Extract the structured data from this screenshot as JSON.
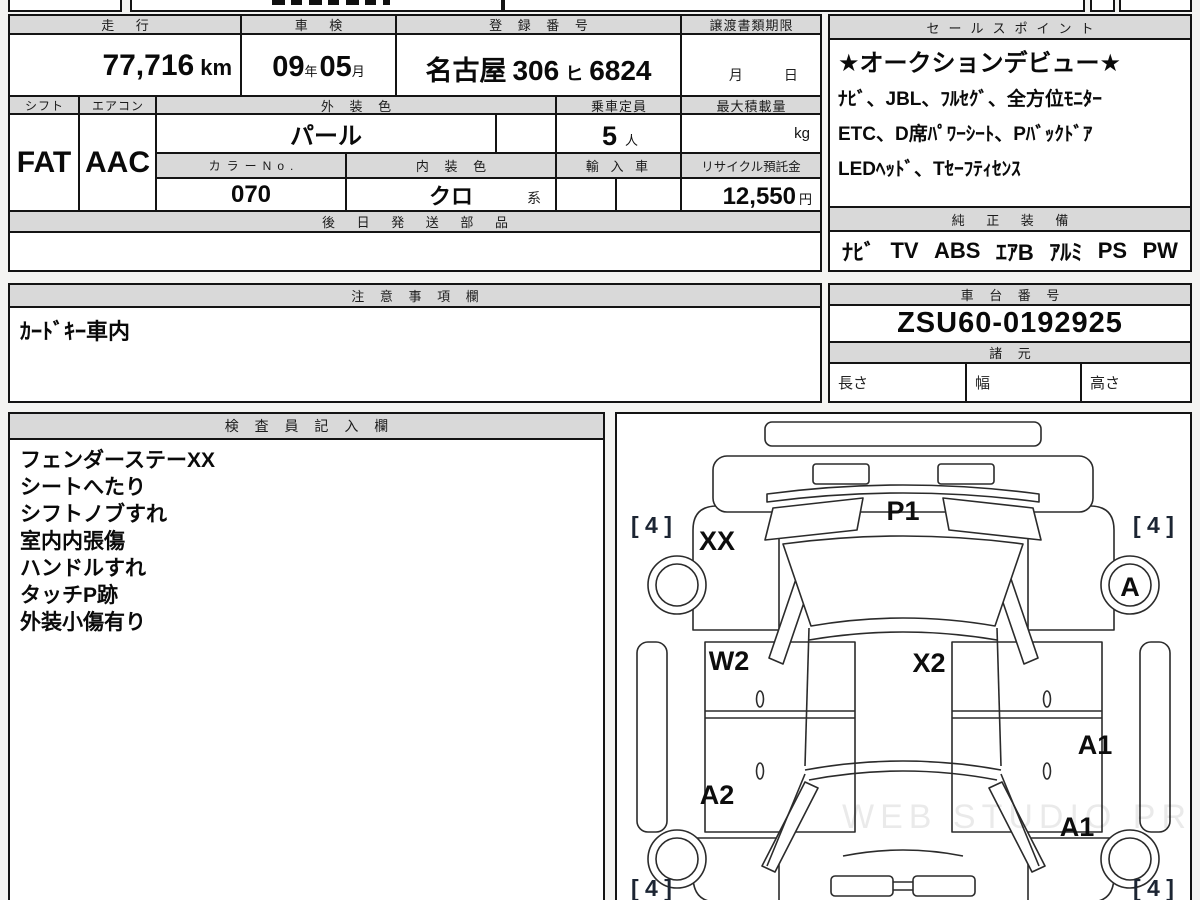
{
  "palette": {
    "header_fill": "#d9d9d9",
    "paper": "#ffffff",
    "line": "#141414"
  },
  "main": {
    "headers": {
      "mileage": "走 行",
      "inspection": "車 検",
      "registration": "登 録 番 号",
      "transfer_deadline": "譲渡書類期限",
      "shift": "シフト",
      "aircon": "エアコン",
      "exterior_color": "外 装 色",
      "capacity": "乗車定員",
      "max_load": "最大積載量",
      "color_no": "カラーNo.",
      "interior_color": "内 装 色",
      "import_car": "輸 入 車",
      "recycle_deposit": "リサイクル預託金",
      "later_parts": "後 日 発 送 部 品"
    },
    "values": {
      "mileage": "77,716",
      "mileage_unit": "km",
      "inspection_year": "09",
      "inspection_year_unit": "年",
      "inspection_month": "05",
      "inspection_month_unit": "月",
      "plate_city": "名古屋",
      "plate_class": "306",
      "plate_kana": "ヒ",
      "plate_number": "6824",
      "transfer_month": "月",
      "transfer_day": "日",
      "shift": "FAT",
      "aircon": "AAC",
      "exterior_color": "パール",
      "capacity": "5",
      "capacity_unit": "人",
      "max_load_unit": "kg",
      "color_no": "070",
      "interior_color": "クロ",
      "interior_suffix": "系",
      "recycle_amount": "12,550",
      "recycle_unit": "円"
    }
  },
  "sales": {
    "title": "セールスポイント",
    "lines": [
      "★オークションデビュー★",
      "ﾅﾋﾞ、JBL、ﾌﾙｾｸﾞ、全方位ﾓﾆﾀｰ",
      "ETC、D席ﾊﾟﾜｰｼｰﾄ、Pﾊﾞｯｸﾄﾞｱ",
      "LEDﾍｯﾄﾞ、Tｾｰﾌﾃｨｾﾝｽ"
    ]
  },
  "equipment": {
    "title": "純 正 装 備",
    "items": [
      "ﾅﾋﾞ",
      "TV",
      "ABS",
      "ｴｱB",
      "ｱﾙﾐ",
      "PS",
      "PW"
    ]
  },
  "notes": {
    "title": "注 意 事 項 欄",
    "line": "ｶｰﾄﾞｷｰ車内"
  },
  "chassis": {
    "title": "車 台 番 号",
    "value": "ZSU60-0192925"
  },
  "specs": {
    "title": "諸 元",
    "length_label": "長さ",
    "width_label": "幅",
    "height_label": "高さ"
  },
  "inspector": {
    "title": "検 査 員 記 入 欄",
    "lines": [
      "フェンダーステーXX",
      "シートへたり",
      "シフトノブすれ",
      "室内内張傷",
      "ハンドルすれ",
      "タッチP跡",
      "外装小傷有り"
    ]
  },
  "diagram": {
    "labels": {
      "p1": "P1",
      "xx": "XX",
      "a": "A",
      "x2": "X2",
      "w2": "W2",
      "a2": "A2",
      "a1_upper": "A1",
      "a1_lower": "A1",
      "tread_front_left": "[ 4 ]",
      "tread_front_right": "[ 4 ]",
      "tread_rear_left": "[ 4 ]",
      "tread_rear_right": "[ 4 ]"
    },
    "watermark": "WEB STUDIO PRO"
  }
}
